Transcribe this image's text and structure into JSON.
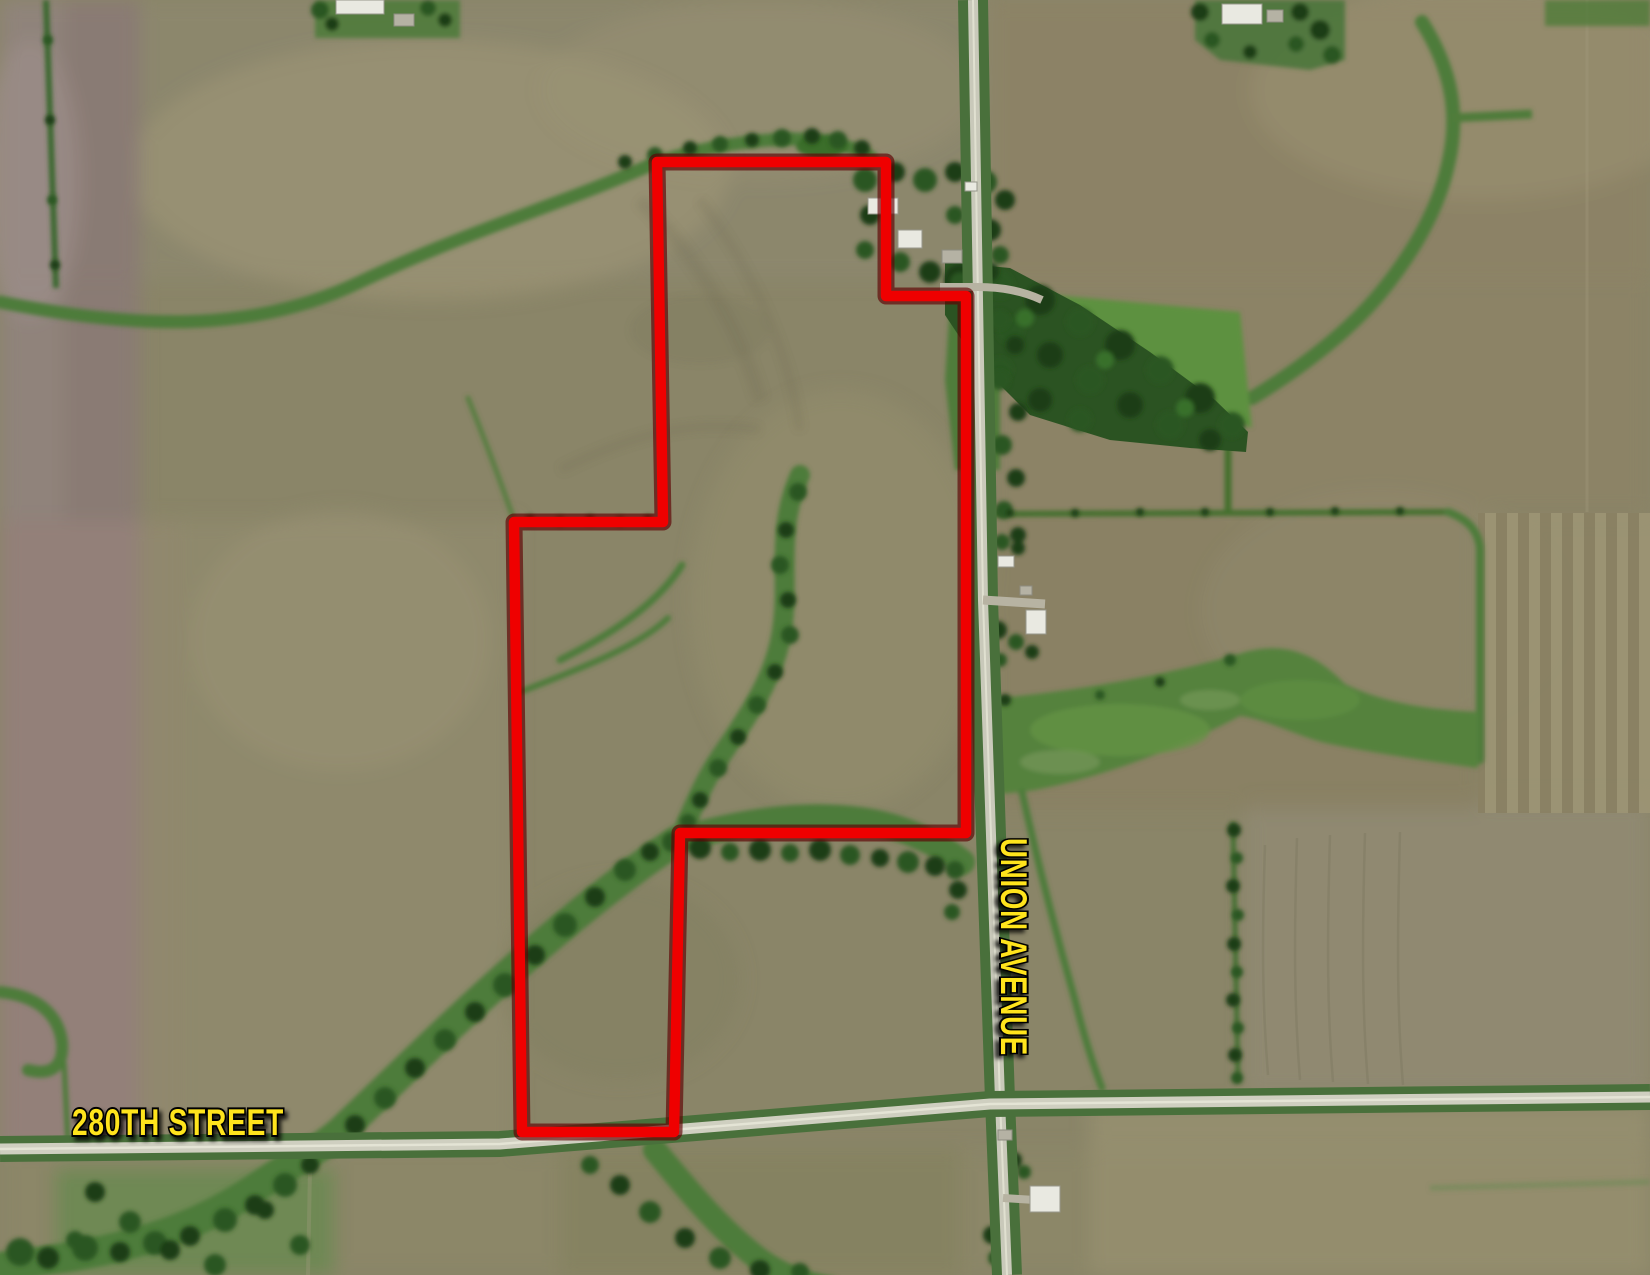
{
  "map": {
    "type": "aerial-satellite-plat",
    "roads": {
      "horizontal": {
        "label": "280TH STREET"
      },
      "vertical": {
        "label": "UNION AVENUE"
      }
    },
    "label_style": {
      "color": "#ffe41a",
      "outline": "#000000"
    },
    "boundary": {
      "color": "#ef0000",
      "halo_color": "#5e0002",
      "points": "657,162 886,162 886,296 966,296 966,833 680,833 674,1132 522,1132 514,522 663,522"
    },
    "terrain_palette": {
      "field_olive": "#8a8568",
      "field_pale": "#a09878",
      "field_mauve": "#94807a",
      "waterway_green": "#4e7c3a",
      "meadow_green": "#5d9140",
      "forest_green": "#2b5322",
      "road_gray": "#ccccbe"
    }
  }
}
